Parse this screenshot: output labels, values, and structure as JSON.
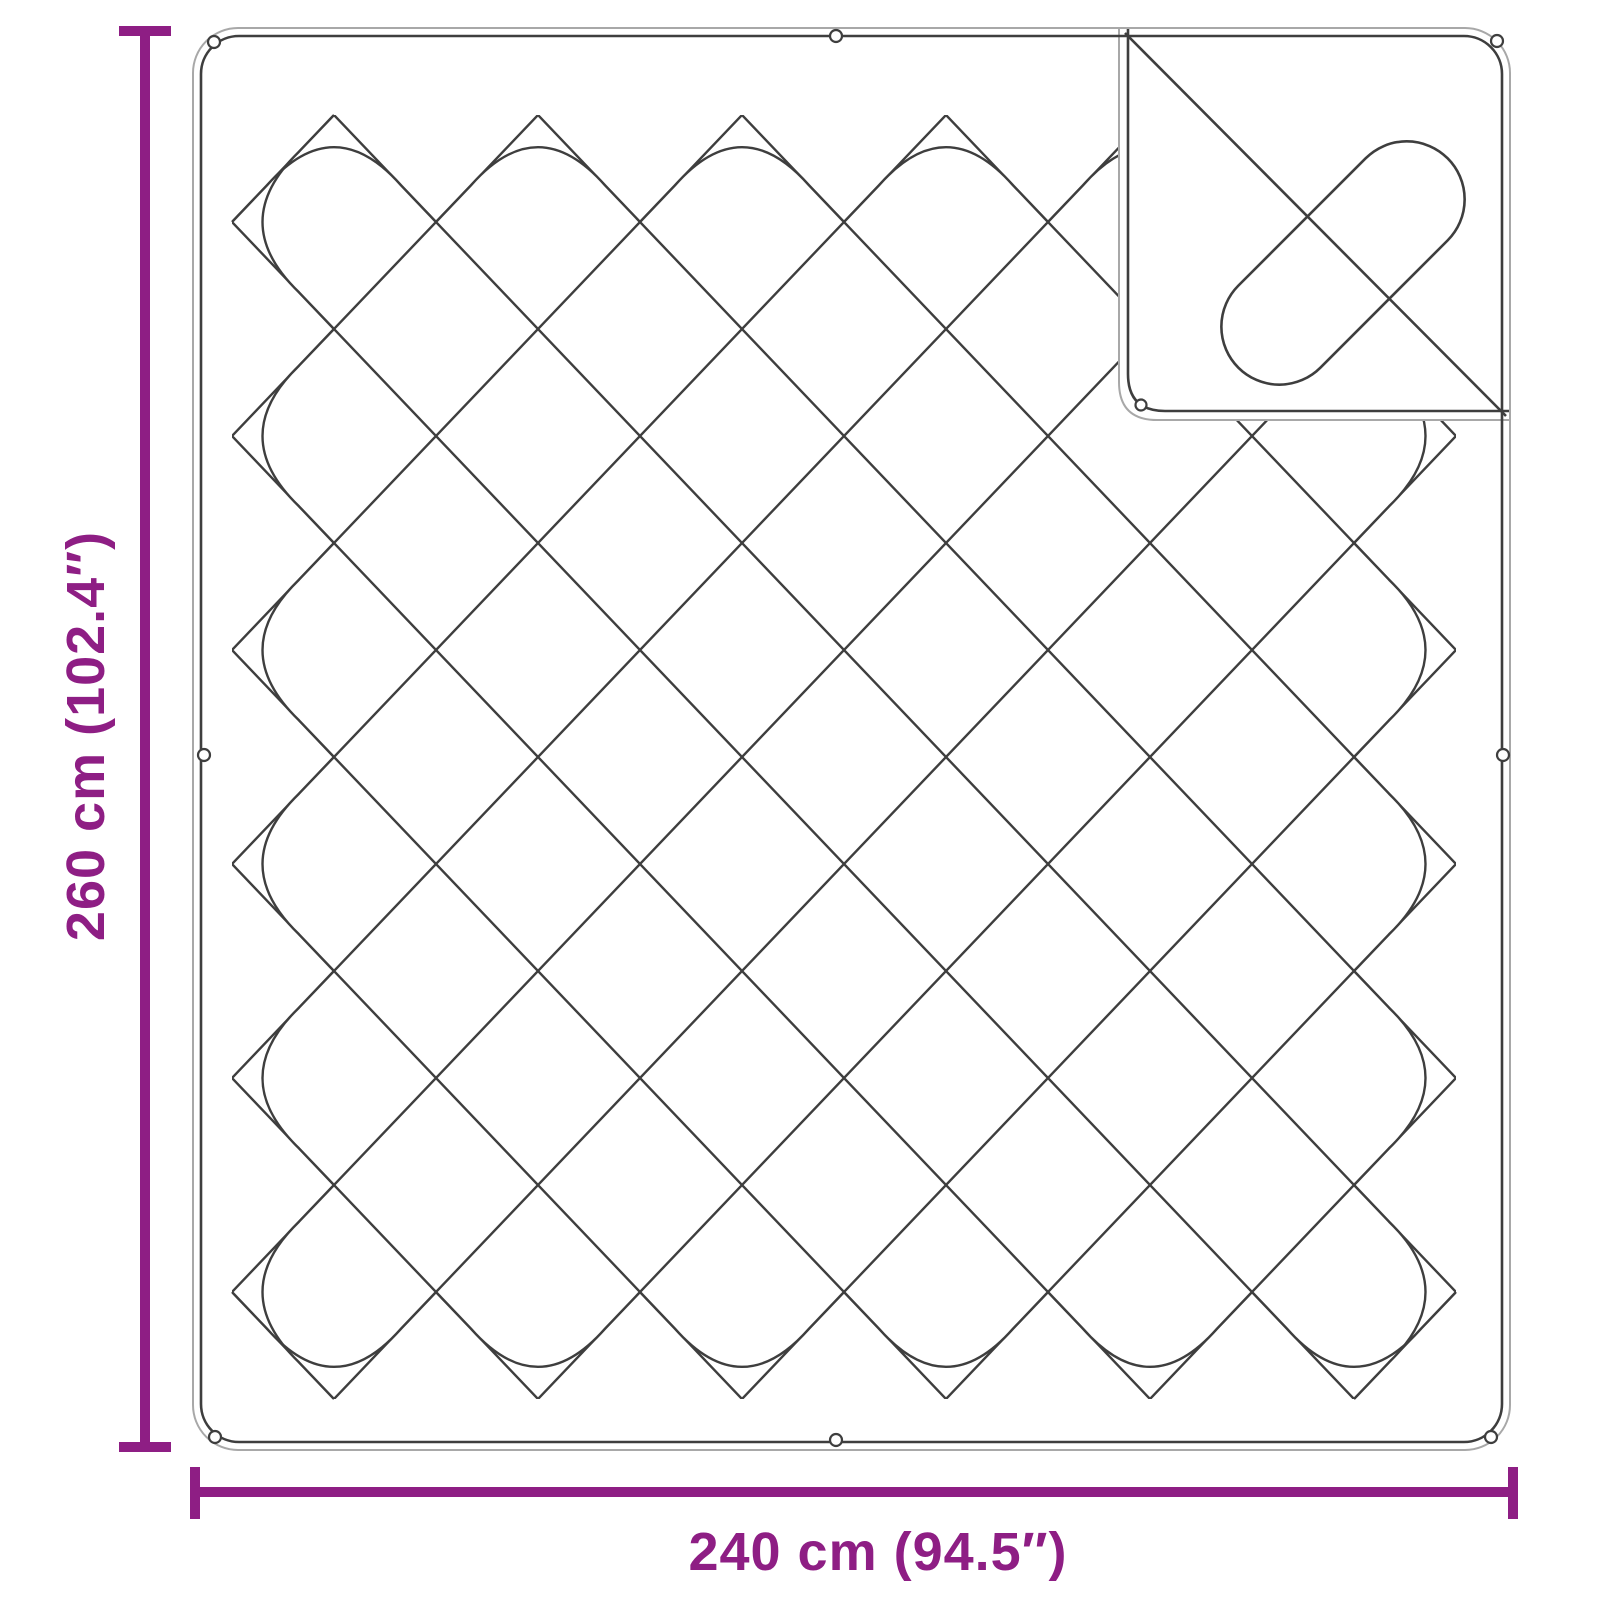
{
  "theme": {
    "accent": "#8e1e84",
    "line-dark": "#3e3e3e",
    "line-light": "#a8a8a8",
    "canvas-bg": "#ffffff"
  },
  "product_diagram": {
    "object": "quilted blanket with folded-over corner",
    "view": "top view dimension drawing",
    "pattern": "diamond quilting",
    "folded_corner_position": "top-right",
    "edge_loops_count": 9,
    "height_label": "260 cm (102.4″)",
    "width_label": "240 cm (94.5″)",
    "height_cm": 260,
    "height_inches": 102.4,
    "width_cm": 240,
    "width_inches": 94.5
  }
}
